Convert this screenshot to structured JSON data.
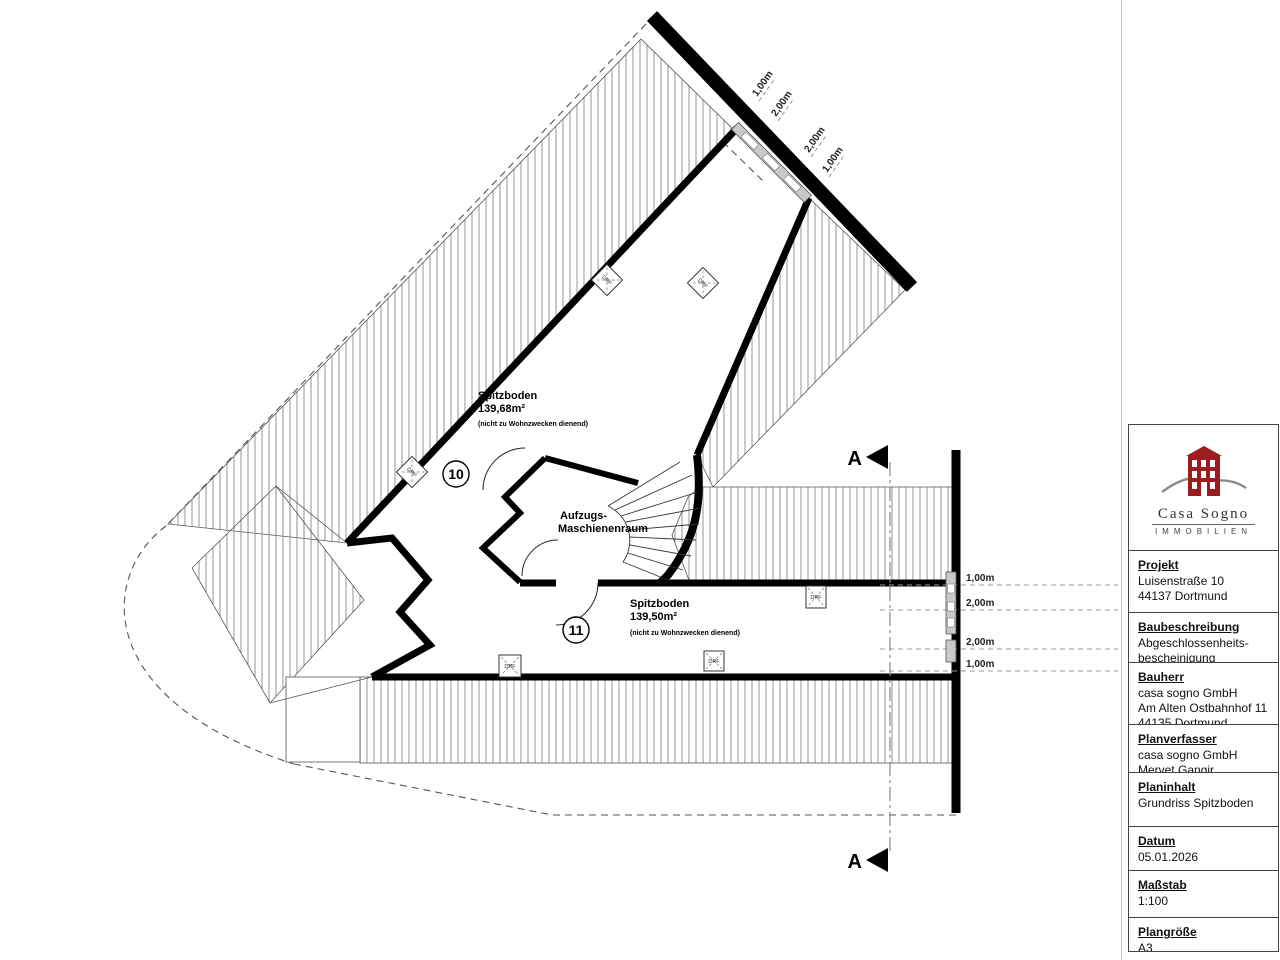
{
  "plan": {
    "rooms": [
      {
        "number": "10",
        "name": "Spitzboden",
        "area": "139,68m²",
        "note": "(nicht zu Wohnzwecken dienend)"
      },
      {
        "number": "11",
        "name": "Spitzboden",
        "area": "139,50m²",
        "note": "(nicht zu Wohnzwecken dienend)"
      }
    ],
    "machine_room": {
      "line1": "Aufzugs-",
      "line2": "Maschienenraum"
    },
    "window_marker_label": "DRF",
    "section_marker": "A",
    "dims_diagonal": [
      "1,00m",
      "2,00m",
      "2,00m",
      "1,00m"
    ],
    "dims_right": [
      "1,00m",
      "2,00m",
      "2,00m",
      "1,00m"
    ]
  },
  "titleblock": {
    "logo": {
      "line1": "Casa Sogno",
      "line2": "IMMOBILIEN"
    },
    "sections": [
      {
        "heading": "Projekt",
        "lines": [
          "Luisenstraße 10",
          "44137 Dortmund"
        ]
      },
      {
        "heading": "Baubeschreibung",
        "lines": [
          "Abgeschlossenheits-",
          "bescheinigung"
        ]
      },
      {
        "heading": "Bauherr",
        "lines": [
          "casa sogno GmbH",
          "Am Alten Ostbahnhof 11",
          "44135 Dortmund"
        ]
      },
      {
        "heading": "Planverfasser",
        "lines": [
          "casa sogno GmbH",
          "Mervet Gangir"
        ]
      },
      {
        "heading": "Planinhalt",
        "lines": [
          "Grundriss Spitzboden"
        ]
      },
      {
        "heading": "Datum",
        "lines": [
          "05.01.2026"
        ]
      },
      {
        "heading": "Maßstab",
        "lines": [
          "1:100"
        ]
      },
      {
        "heading": "Plangröße",
        "lines": [
          "A3"
        ]
      }
    ]
  },
  "colors": {
    "brand_red": "#9c1c20",
    "wall": "#000000",
    "hatch": "#8a8a8a"
  }
}
